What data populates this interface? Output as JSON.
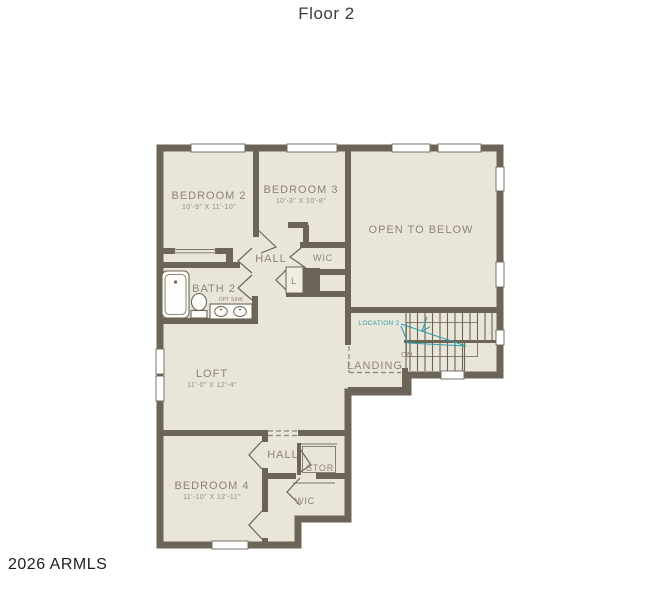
{
  "page": {
    "title": "Floor 2",
    "watermark": "2026 ARMLS"
  },
  "colors": {
    "wall": "#6c6557",
    "floor": "#e9e5d8",
    "label_text": "#8d8475",
    "annotation_teal": "#2f9fae",
    "background": "#ffffff"
  },
  "rooms": {
    "bedroom2": {
      "label": "BEDROOM 2",
      "dims": "10'-9\" X 11'-10\""
    },
    "bedroom3": {
      "label": "BEDROOM 3",
      "dims": "10'-3\" X 10'-8\""
    },
    "open_to_below": {
      "label": "OPEN TO BELOW"
    },
    "hall_upper": {
      "label": "HALL"
    },
    "wic_upper": {
      "label": "WIC"
    },
    "linen": {
      "label": "L"
    },
    "bath2": {
      "label": "BATH 2",
      "note": "OPT SINK"
    },
    "landing": {
      "label": "LANDING"
    },
    "loft": {
      "label": "LOFT",
      "dims": "11'-0\" X 12'-4\""
    },
    "bedroom4": {
      "label": "BEDROOM 4",
      "dims": "11'-10\" X 12'-11\""
    },
    "hall_lower": {
      "label": "HALL"
    },
    "storage": {
      "label": "STOR"
    },
    "wic_lower": {
      "label": "WIC"
    }
  },
  "stairs": {
    "down_label": "DN",
    "location_label": "LOCATION 2"
  }
}
